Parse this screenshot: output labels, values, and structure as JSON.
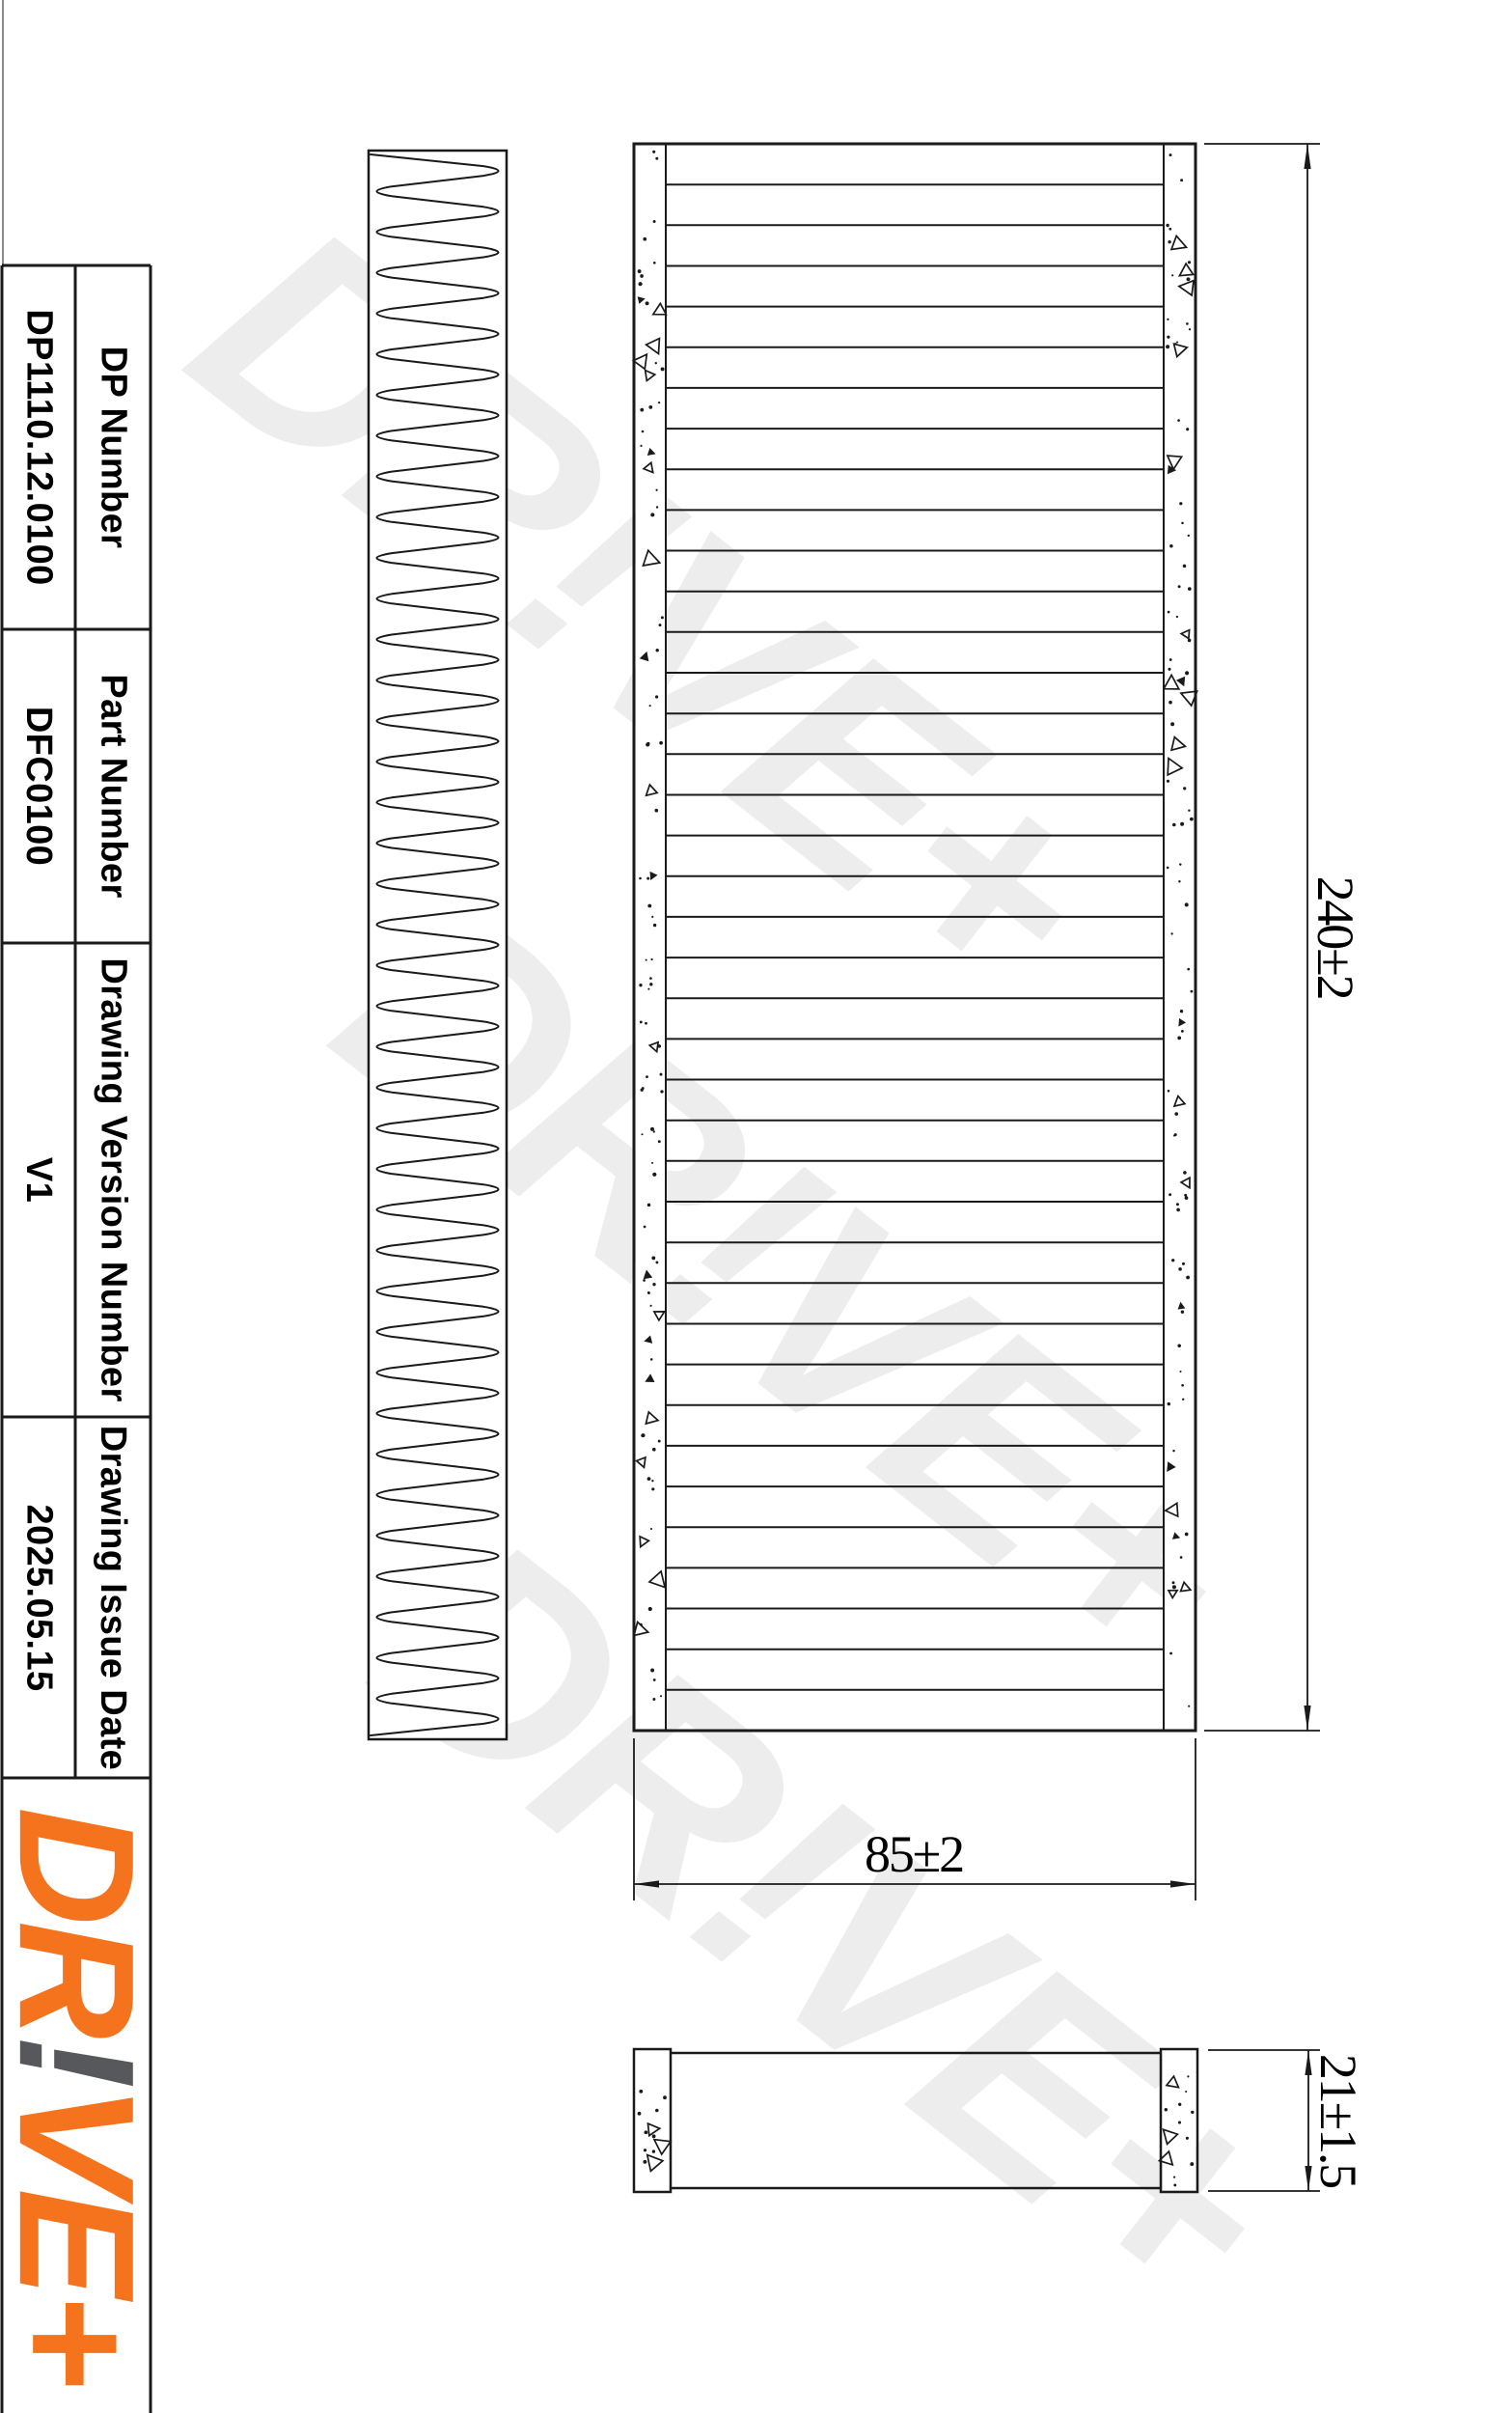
{
  "title_block": {
    "rows": [
      {
        "label": "DP Number",
        "value": "DP1110.12.0100"
      },
      {
        "label": "Part Number",
        "value": "DFC0100"
      },
      {
        "label": "Drawing Version Number",
        "value": "V1"
      },
      {
        "label": "Drawing Issue Date",
        "value": "2025.05.15"
      }
    ],
    "logo": {
      "part1": "DR",
      "excl": "!",
      "part2": "VE+",
      "orange_color": "#F6731D",
      "gray_color": "#57585C"
    }
  },
  "views": {
    "side_pleat_view": "pleated-filter-side-profile",
    "front_view": "filter-front-face-with-pleat-edges",
    "bottom_view": "filter-thickness-profile"
  },
  "dimensions": {
    "height_label": "240±2",
    "width_label": "85±2",
    "thickness_label": "21±1.5"
  },
  "watermark": {
    "text": "DR!VE+",
    "color": "#EDEDED"
  },
  "drawing": {
    "pleat_cycles": 39,
    "pleat_edge_lines": 38,
    "line_color": "#1a1a1a"
  }
}
